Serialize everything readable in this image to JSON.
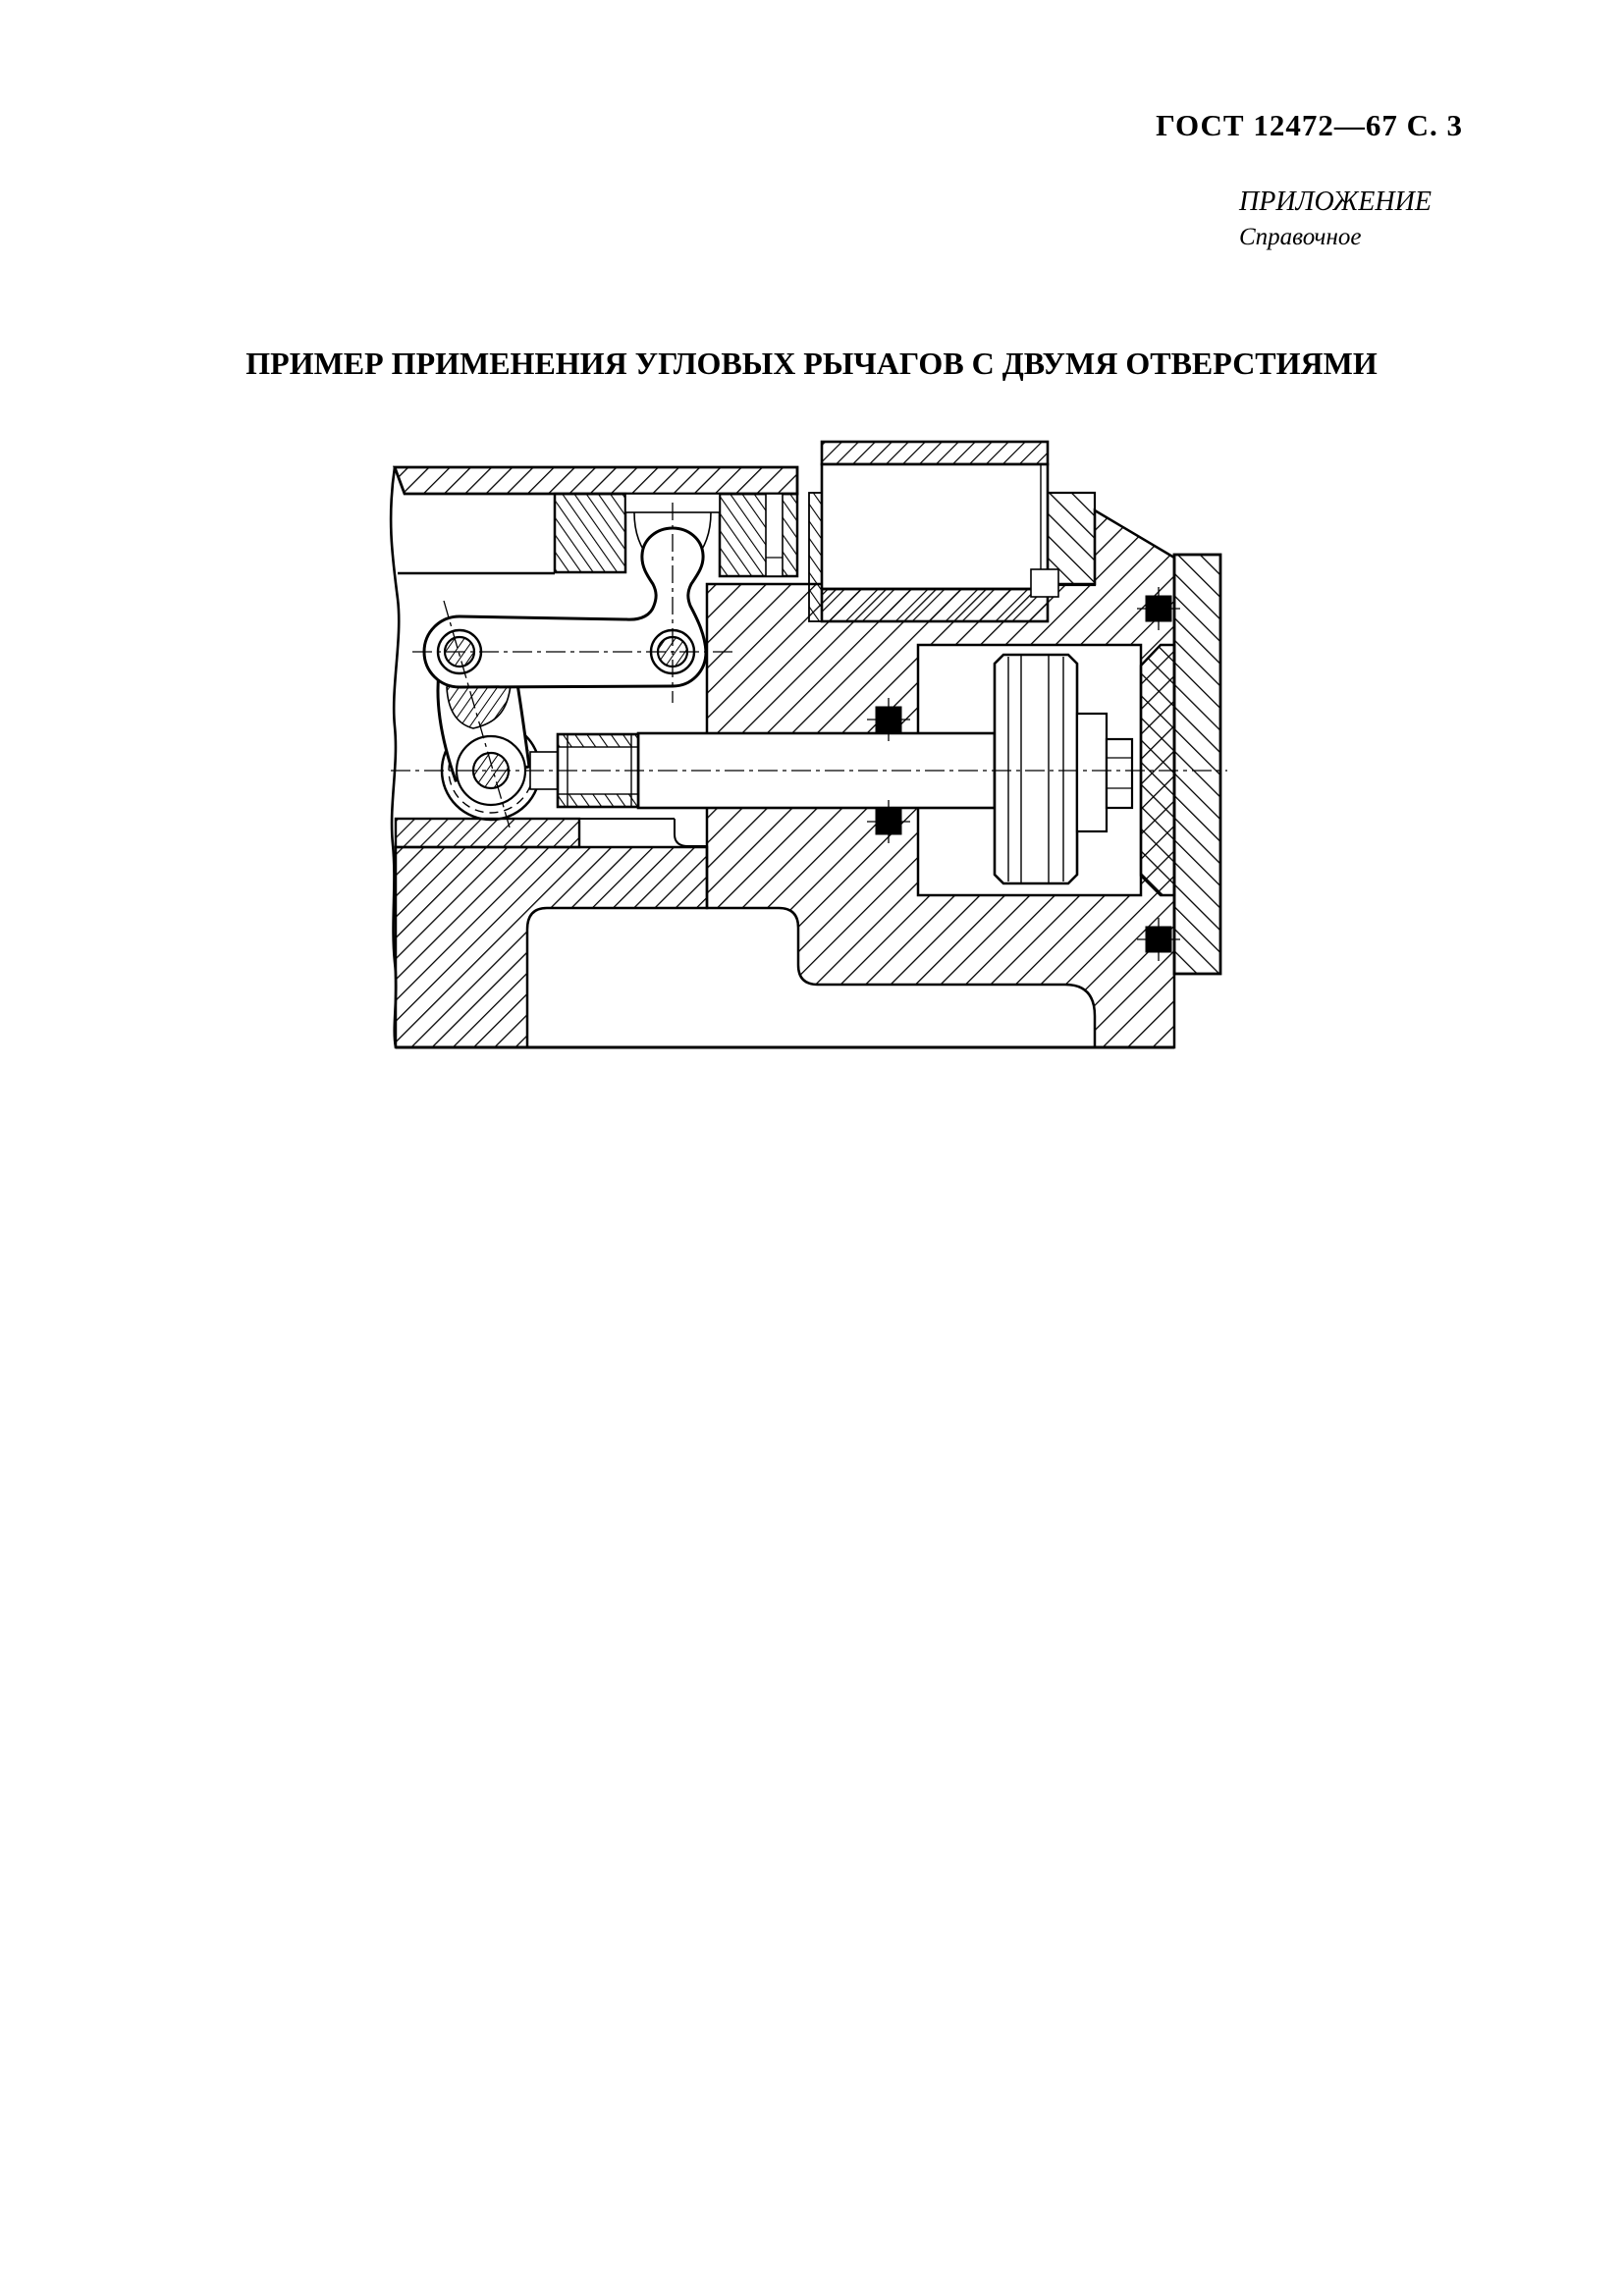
{
  "page": {
    "header": "ГОСТ 12472—67 С. 3",
    "appendix_label": "ПРИЛОЖЕНИЕ",
    "appendix_type": "Справочное",
    "title": "ПРИМЕР ПРИМЕНЕНИЯ УГЛОВЫХ РЫЧАГОВ С ДВУМЯ ОТВЕРСТИЯМИ",
    "figure": {
      "kind": "engineering-cross-section",
      "page_number_shown_in_header": "3",
      "standard_number_shown_in_header": "12472—67"
    }
  },
  "colors": {
    "ink": "#000000",
    "paper": "#ffffff"
  }
}
